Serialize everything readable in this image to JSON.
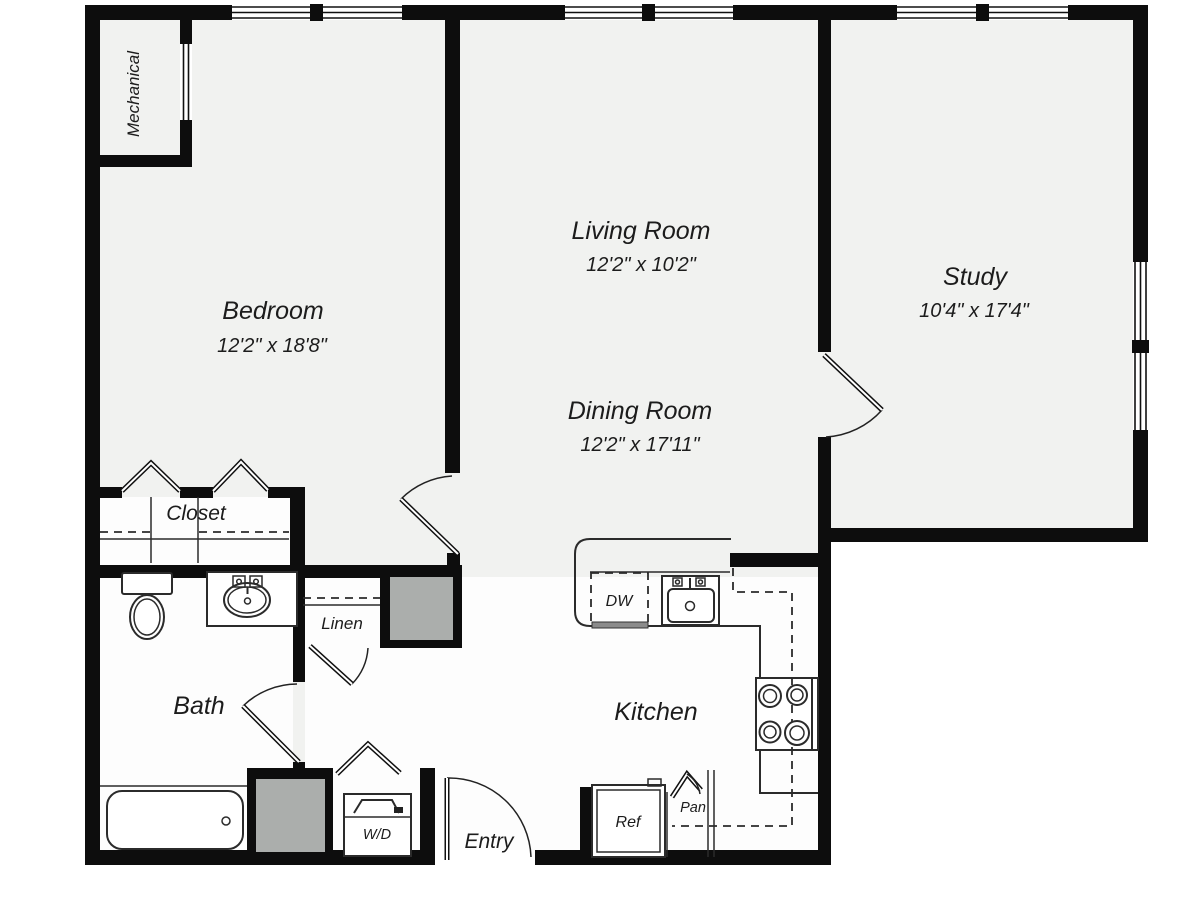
{
  "title": "Apartment Floor Plan",
  "colors": {
    "wall": "#0d0d0d",
    "line": "#2b2b2b",
    "room": "#f1f2f0",
    "white": "#fdfdfd",
    "shaft": "#abaeac"
  },
  "rooms": {
    "mechanical": {
      "name": "Mechanical"
    },
    "bedroom": {
      "name": "Bedroom",
      "dims": "12'2\" x 18'8\""
    },
    "living": {
      "name": "Living Room",
      "dims": "12'2\" x 10'2\""
    },
    "dining": {
      "name": "Dining Room",
      "dims": "12'2\" x 17'11\""
    },
    "study": {
      "name": "Study",
      "dims": "10'4\" x 17'4\""
    },
    "closet": {
      "name": "Closet"
    },
    "linen": {
      "name": "Linen"
    },
    "bath": {
      "name": "Bath"
    },
    "kitchen": {
      "name": "Kitchen"
    },
    "entry": {
      "name": "Entry"
    }
  },
  "fixtures": {
    "dishwasher": "DW",
    "refrigerator": "Ref",
    "pantry": "Pan",
    "washer_dryer": "W/D"
  }
}
